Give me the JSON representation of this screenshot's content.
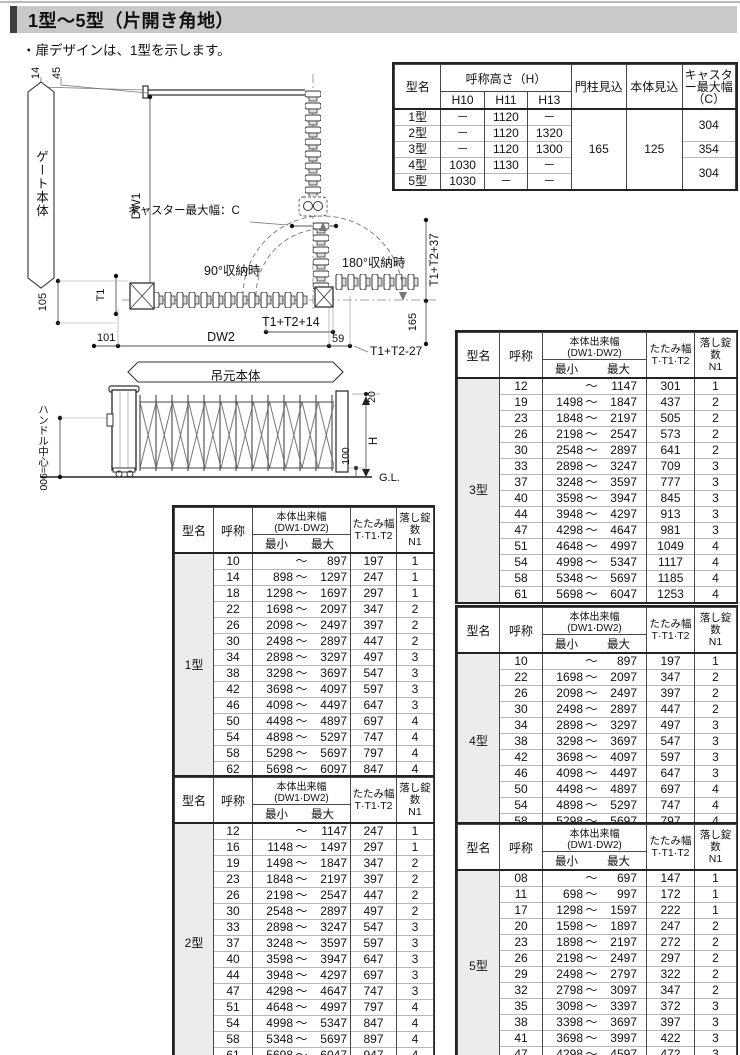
{
  "page": {
    "title": "1型〜5型（片開き角地）",
    "note": "・扉デザインは、1型を示します。"
  },
  "summary_table": {
    "headers": {
      "model": "型名",
      "height_group": "呼称高さ（H）",
      "h10": "H10",
      "h11": "H11",
      "h13": "H13",
      "pillar": "門柱見込",
      "body": "本体見込",
      "caster": "キャスター最大幅（C）"
    },
    "rows": [
      {
        "name": "1型",
        "h10": "－",
        "h11": "1120",
        "h13": "－"
      },
      {
        "name": "2型",
        "h10": "－",
        "h11": "1120",
        "h13": "1320"
      },
      {
        "name": "3型",
        "h10": "－",
        "h11": "1120",
        "h13": "1300"
      },
      {
        "name": "4型",
        "h10": "1030",
        "h11": "1130",
        "h13": "－"
      },
      {
        "name": "5型",
        "h10": "1030",
        "h11": "－",
        "h13": "－"
      }
    ],
    "pillar_value": "165",
    "body_value": "125",
    "caster_12": "304",
    "caster_3": "354",
    "caster_45": "304"
  },
  "spec_header": {
    "model": "型名",
    "name": "呼称",
    "width": "本体出来幅(DW1·DW2)",
    "min": "最小",
    "max": "最大",
    "fold1": "たたみ幅",
    "fold2": "T·T1·T2",
    "lock1": "落し錠数",
    "lock2": "N1"
  },
  "spec_tables": {
    "t1": {
      "model": "1型",
      "rows": [
        [
          "10",
          "",
          "～",
          "897",
          "197",
          "1"
        ],
        [
          "14",
          "898",
          "～",
          "1297",
          "247",
          "1"
        ],
        [
          "18",
          "1298",
          "～",
          "1697",
          "297",
          "1"
        ],
        [
          "22",
          "1698",
          "～",
          "2097",
          "347",
          "2"
        ],
        [
          "26",
          "2098",
          "～",
          "2497",
          "397",
          "2"
        ],
        [
          "30",
          "2498",
          "～",
          "2897",
          "447",
          "2"
        ],
        [
          "34",
          "2898",
          "～",
          "3297",
          "497",
          "3"
        ],
        [
          "38",
          "3298",
          "～",
          "3697",
          "547",
          "3"
        ],
        [
          "42",
          "3698",
          "～",
          "4097",
          "597",
          "3"
        ],
        [
          "46",
          "4098",
          "～",
          "4497",
          "647",
          "3"
        ],
        [
          "50",
          "4498",
          "～",
          "4897",
          "697",
          "4"
        ],
        [
          "54",
          "4898",
          "～",
          "5297",
          "747",
          "4"
        ],
        [
          "58",
          "5298",
          "～",
          "5697",
          "797",
          "4"
        ],
        [
          "62",
          "5698",
          "～",
          "6097",
          "847",
          "4"
        ]
      ]
    },
    "t2": {
      "model": "2型",
      "rows": [
        [
          "12",
          "",
          "～",
          "1147",
          "247",
          "1"
        ],
        [
          "16",
          "1148",
          "～",
          "1497",
          "297",
          "1"
        ],
        [
          "19",
          "1498",
          "～",
          "1847",
          "347",
          "2"
        ],
        [
          "23",
          "1848",
          "～",
          "2197",
          "397",
          "2"
        ],
        [
          "26",
          "2198",
          "～",
          "2547",
          "447",
          "2"
        ],
        [
          "30",
          "2548",
          "～",
          "2897",
          "497",
          "2"
        ],
        [
          "33",
          "2898",
          "～",
          "3247",
          "547",
          "3"
        ],
        [
          "37",
          "3248",
          "～",
          "3597",
          "597",
          "3"
        ],
        [
          "40",
          "3598",
          "～",
          "3947",
          "647",
          "3"
        ],
        [
          "44",
          "3948",
          "～",
          "4297",
          "697",
          "3"
        ],
        [
          "47",
          "4298",
          "～",
          "4647",
          "747",
          "3"
        ],
        [
          "51",
          "4648",
          "～",
          "4997",
          "797",
          "4"
        ],
        [
          "54",
          "4998",
          "～",
          "5347",
          "847",
          "4"
        ],
        [
          "58",
          "5348",
          "～",
          "5697",
          "897",
          "4"
        ],
        [
          "61",
          "5698",
          "～",
          "6047",
          "947",
          "4"
        ]
      ]
    },
    "t3": {
      "model": "3型",
      "rows": [
        [
          "12",
          "",
          "～",
          "1147",
          "301",
          "1"
        ],
        [
          "19",
          "1498",
          "～",
          "1847",
          "437",
          "2"
        ],
        [
          "23",
          "1848",
          "～",
          "2197",
          "505",
          "2"
        ],
        [
          "26",
          "2198",
          "～",
          "2547",
          "573",
          "2"
        ],
        [
          "30",
          "2548",
          "～",
          "2897",
          "641",
          "2"
        ],
        [
          "33",
          "2898",
          "～",
          "3247",
          "709",
          "3"
        ],
        [
          "37",
          "3248",
          "～",
          "3597",
          "777",
          "3"
        ],
        [
          "40",
          "3598",
          "～",
          "3947",
          "845",
          "3"
        ],
        [
          "44",
          "3948",
          "～",
          "4297",
          "913",
          "3"
        ],
        [
          "47",
          "4298",
          "～",
          "4647",
          "981",
          "3"
        ],
        [
          "51",
          "4648",
          "～",
          "4997",
          "1049",
          "4"
        ],
        [
          "54",
          "4998",
          "～",
          "5347",
          "1117",
          "4"
        ],
        [
          "58",
          "5348",
          "～",
          "5697",
          "1185",
          "4"
        ],
        [
          "61",
          "5698",
          "～",
          "6047",
          "1253",
          "4"
        ]
      ]
    },
    "t4": {
      "model": "4型",
      "rows": [
        [
          "10",
          "",
          "～",
          "897",
          "197",
          "1"
        ],
        [
          "22",
          "1698",
          "～",
          "2097",
          "347",
          "2"
        ],
        [
          "26",
          "2098",
          "～",
          "2497",
          "397",
          "2"
        ],
        [
          "30",
          "2498",
          "～",
          "2897",
          "447",
          "2"
        ],
        [
          "34",
          "2898",
          "～",
          "3297",
          "497",
          "3"
        ],
        [
          "38",
          "3298",
          "～",
          "3697",
          "547",
          "3"
        ],
        [
          "42",
          "3698",
          "～",
          "4097",
          "597",
          "3"
        ],
        [
          "46",
          "4098",
          "～",
          "4497",
          "647",
          "3"
        ],
        [
          "50",
          "4498",
          "～",
          "4897",
          "697",
          "4"
        ],
        [
          "54",
          "4898",
          "～",
          "5297",
          "747",
          "4"
        ],
        [
          "58",
          "5298",
          "～",
          "5697",
          "797",
          "4"
        ]
      ]
    },
    "t5": {
      "model": "5型",
      "rows": [
        [
          "08",
          "",
          "～",
          "697",
          "147",
          "1"
        ],
        [
          "11",
          "698",
          "～",
          "997",
          "172",
          "1"
        ],
        [
          "17",
          "1298",
          "～",
          "1597",
          "222",
          "1"
        ],
        [
          "20",
          "1598",
          "～",
          "1897",
          "247",
          "2"
        ],
        [
          "23",
          "1898",
          "～",
          "2197",
          "272",
          "2"
        ],
        [
          "26",
          "2198",
          "～",
          "2497",
          "297",
          "2"
        ],
        [
          "29",
          "2498",
          "～",
          "2797",
          "322",
          "2"
        ],
        [
          "32",
          "2798",
          "～",
          "3097",
          "347",
          "2"
        ],
        [
          "35",
          "3098",
          "～",
          "3397",
          "372",
          "3"
        ],
        [
          "38",
          "3398",
          "～",
          "3697",
          "397",
          "3"
        ],
        [
          "41",
          "3698",
          "～",
          "3997",
          "422",
          "3"
        ],
        [
          "47",
          "4298",
          "～",
          "4597",
          "472",
          "3"
        ]
      ]
    }
  },
  "diagram": {
    "dim_14": "14",
    "dim_45": "45",
    "gate_body": "ゲート本体",
    "dw1": "DW1",
    "caster_label": "キャスター最大幅：C",
    "t1": "T1",
    "dim_105": "105",
    "dim_101": "101",
    "dw2": "DW2",
    "dim_59": "59",
    "fold90": "90°収納時",
    "fold180": "180°収納時",
    "t1t2p37": "T1+T2+37",
    "t1t2p14": "T1+T2+14",
    "t1t2m27": "T1+T2-27",
    "dim_165": "165",
    "hanger_body": "吊元本体",
    "handle": "ハンドル中心=900",
    "dim_20": "20",
    "h": "H",
    "dim_100": "100",
    "gl": "G.L."
  },
  "colors": {
    "titlebar_bg": "#c9c9c9",
    "titlebar_accent": "#3f3f3f",
    "group_cell_bg": "#ececec",
    "border_dark": "#222222"
  }
}
